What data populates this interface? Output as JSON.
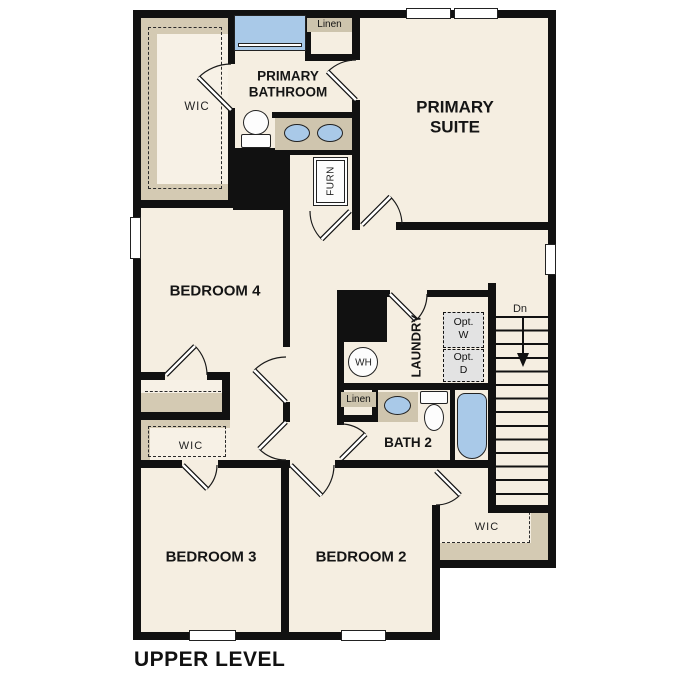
{
  "plan_title": "UPPER LEVEL",
  "rooms": {
    "primary_suite": {
      "line1": "PRIMARY",
      "line2": "SUITE"
    },
    "primary_bathroom": {
      "line1": "PRIMARY",
      "line2": "BATHROOM"
    },
    "primary_wic": {
      "label": "WIC"
    },
    "linen_primary": {
      "label": "Linen"
    },
    "furnace_closet": {
      "label": "FURN"
    },
    "bedroom4": {
      "label": "BEDROOM 4"
    },
    "laundry": {
      "label": "LAUNDRY"
    },
    "water_heater": {
      "label": "WH"
    },
    "optional_washer": {
      "line1": "Opt.",
      "line2": "W"
    },
    "optional_dryer": {
      "line1": "Opt.",
      "line2": "D"
    },
    "stairs": {
      "label": "Dn"
    },
    "bath2": {
      "label": "BATH 2"
    },
    "linen_bath2": {
      "label": "Linen"
    },
    "bedroom3": {
      "label": "BEDROOM 3"
    },
    "bedroom3_wic": {
      "label": "WIC"
    },
    "bedroom2": {
      "label": "BEDROOM 2"
    },
    "bedroom2_wic": {
      "label": "WIC"
    }
  },
  "colors": {
    "wall": "#111111",
    "floor": "#f5eee1",
    "shelving_tan": "#d4cab3",
    "fixture_blue": "#a9c9e8",
    "optional_appliance_gray": "#e3e3e3",
    "background": "#ffffff"
  }
}
